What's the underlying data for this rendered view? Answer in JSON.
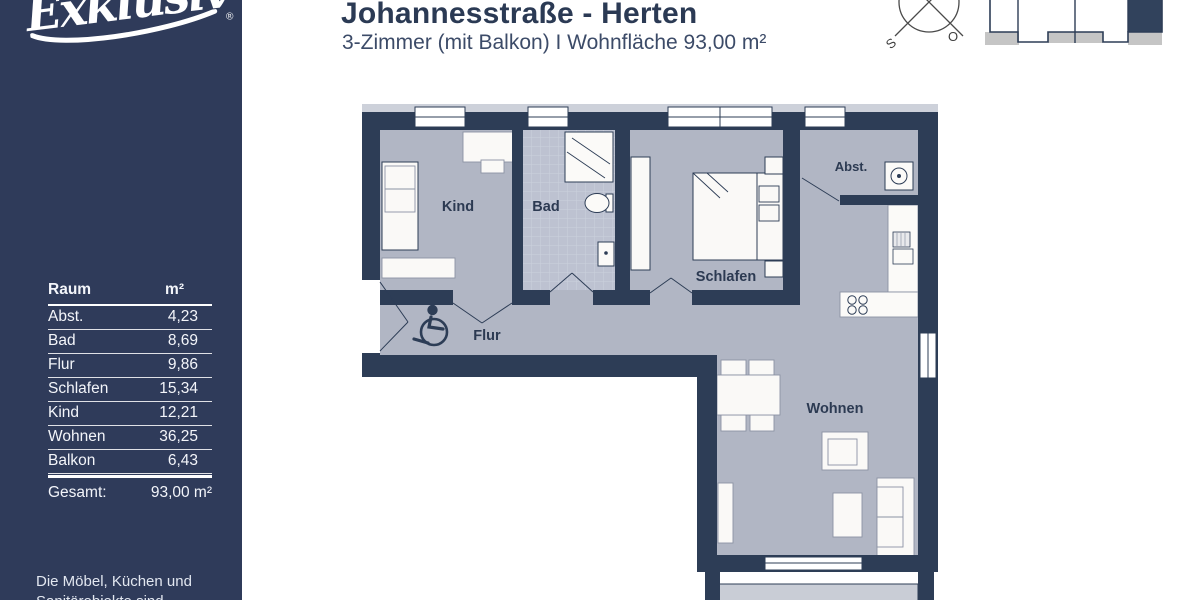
{
  "sidebar": {
    "logo_text": "Exklusiv",
    "logo_mark": "®",
    "table": {
      "col_room": "Raum",
      "col_area": "m²",
      "rows": [
        {
          "room": "Abst.",
          "area": "4,23"
        },
        {
          "room": "Bad",
          "area": "8,69"
        },
        {
          "room": "Flur",
          "area": "9,86"
        },
        {
          "room": "Schlafen",
          "area": "15,34"
        },
        {
          "room": "Kind",
          "area": "12,21"
        },
        {
          "room": "Wohnen",
          "area": "36,25"
        },
        {
          "room": "Balkon",
          "area": "6,43"
        }
      ],
      "total_label": "Gesamt:",
      "total_value": "93,00 m²"
    },
    "disclaimer_line1": "Die Möbel, Küchen und",
    "disclaimer_line2": "Sanitärobjekte sind"
  },
  "header": {
    "title": "Johannesstraße - Herten",
    "subtitle": "3-Zimmer (mit Balkon)  I  Wohnfläche 93,00 m²"
  },
  "compass": {
    "south_label": "S",
    "east_label": "O"
  },
  "floorplan": {
    "room_labels": {
      "kind": "Kind",
      "bad": "Bad",
      "flur": "Flur",
      "schlafen": "Schlafen",
      "abst": "Abst.",
      "wohnen": "Wohnen"
    }
  },
  "colors": {
    "sidebar_bg": "#2f3b5a",
    "wall": "#2d3d56",
    "floor": "#b1b6c4",
    "tile": "#bdc2d1",
    "balcony": "#c9cdd6",
    "title_text": "#2b3a54",
    "keyplan_gray": "#c5c5c5"
  }
}
